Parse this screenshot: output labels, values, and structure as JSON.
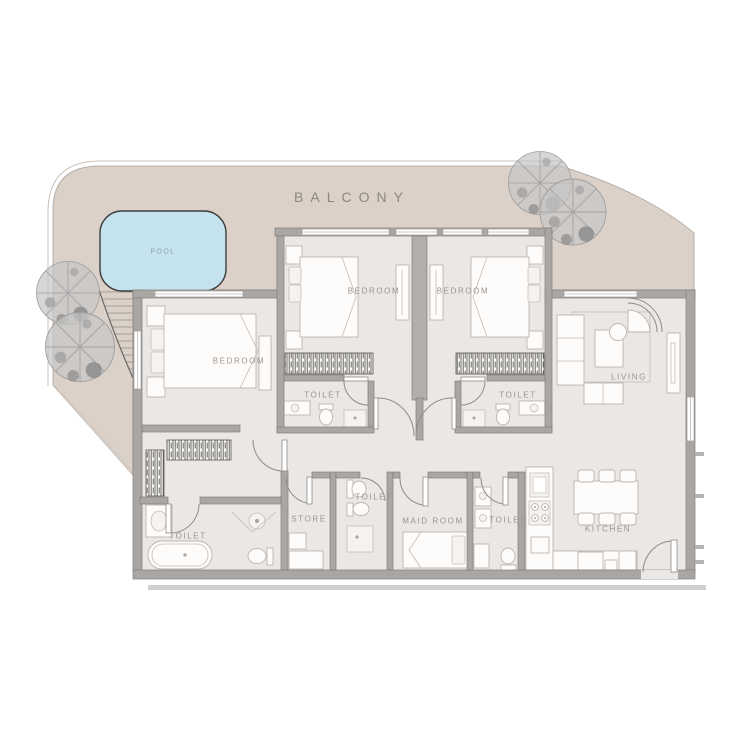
{
  "page": {
    "type": "apartment floor plan",
    "background": "#ffffff"
  },
  "labels": {
    "balcony": "BALCONY",
    "pool": "POOL",
    "bedroom_master": "BEDROOM",
    "bedroom_2": "BEDROOM",
    "bedroom_3": "BEDROOM",
    "living": "LIVING",
    "kitchen": "KITCHEN",
    "store": "STORE",
    "maid_room": "MAID ROOM",
    "toilet_master": "TOILET",
    "toilet_2": "TOILET",
    "toilet_3": "TOILET",
    "toilet_mid": "TOILET",
    "toilet_guest": "TOILET"
  },
  "colors": {
    "balcony_fill": "#dbd1c8",
    "pool_fill": "#c5e3ee",
    "pool_outline": "#3f3e3d",
    "floor_fill": "#ebe7e4",
    "wall_fill": "#a9a6a3",
    "wall_outline": "#827f7c",
    "furniture_fill": "#fdfcfb",
    "furniture_outline": "#bdb5ae",
    "label_color": "#9c948d",
    "balcony_label_color": "#8d8781",
    "tree_fill": "#c6c6c6"
  },
  "furniture_icons": [
    "double-bed-icon",
    "single-bed-icon",
    "wardrobe-icon",
    "closet-icon",
    "sofa-icon",
    "armchair-icon",
    "coffee-table-icon",
    "side-table-icon",
    "tv-unit-icon",
    "dining-table-icon",
    "chair-icon",
    "stove-icon",
    "kitchen-sink-icon",
    "fridge-icon",
    "bathtub-icon",
    "wc-icon",
    "washbasin-icon",
    "shower-icon",
    "pool-icon",
    "tree-icon",
    "deck-steps-icon",
    "door-arc-icon",
    "window-icon"
  ]
}
